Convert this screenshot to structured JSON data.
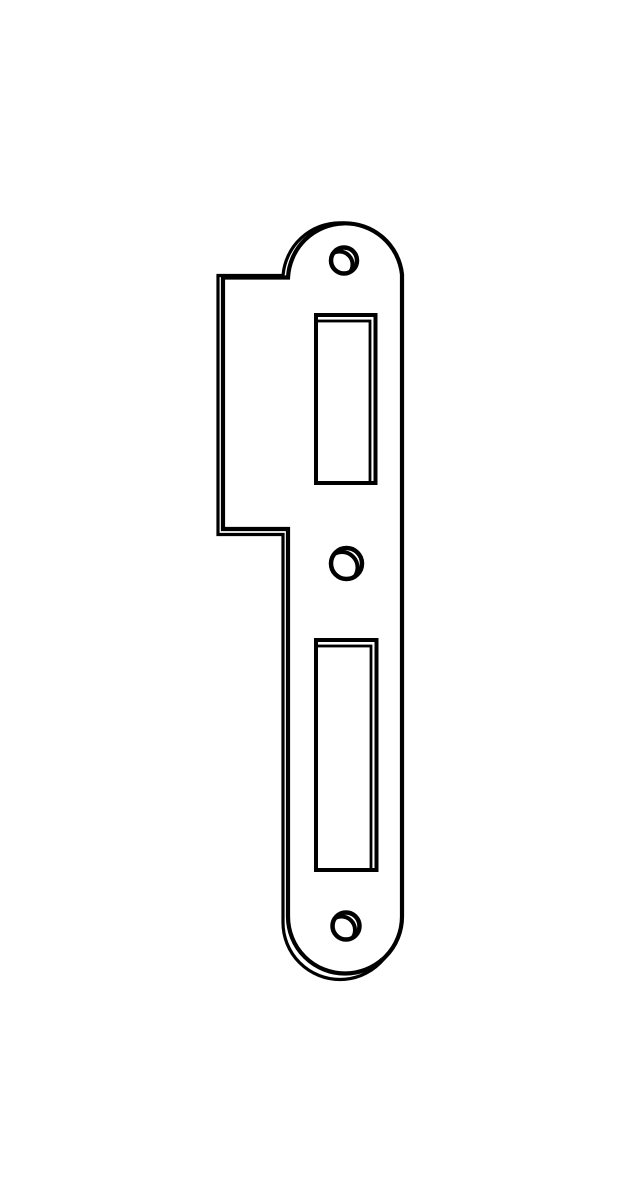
{
  "page": {
    "background_color": "#ffffff"
  },
  "drawing": {
    "part": "strike-plate",
    "line_color": "#000000",
    "face_fill_color": "#ffffff",
    "canvas": {
      "width": 622,
      "height": 1200
    },
    "outline": {
      "front_path": "M 223 277.5 L 288 277.5 A 57.2 57.2 0 0 1 402 274.5 L 402 916.5 A 57 57 0 0 1 288 916.5 L 288 529 L 223 529 Z",
      "back_path": "M 218 275.5 L 283 275.5 A 57.2 57.2 0 0 1 397 275 L 397 922.5 A 57 57 0 0 1 283 922.5 L 283 534.5 L 218 534.5 Z"
    },
    "slots": [
      {
        "name": "latch-slot",
        "x": 316,
        "y": 315,
        "width": 59.5,
        "height": 168,
        "back_x": 310.5,
        "back_y": 321
      },
      {
        "name": "deadbolt-slot",
        "x": 316,
        "y": 640,
        "width": 60.5,
        "height": 230,
        "back_x": 310.5,
        "back_y": 646
      }
    ],
    "holes": [
      {
        "name": "top-screw-hole",
        "cx": 344,
        "cy": 260.5,
        "r": 13,
        "back_cx": 339.5,
        "back_cy": 264.5
      },
      {
        "name": "middle-screw-hole",
        "cx": 346.5,
        "cy": 563.5,
        "r": 15.5,
        "back_cx": 342,
        "back_cy": 567.5
      },
      {
        "name": "bottom-screw-hole",
        "cx": 346,
        "cy": 926,
        "r": 13.5,
        "back_cx": 341.5,
        "back_cy": 930
      }
    ]
  }
}
